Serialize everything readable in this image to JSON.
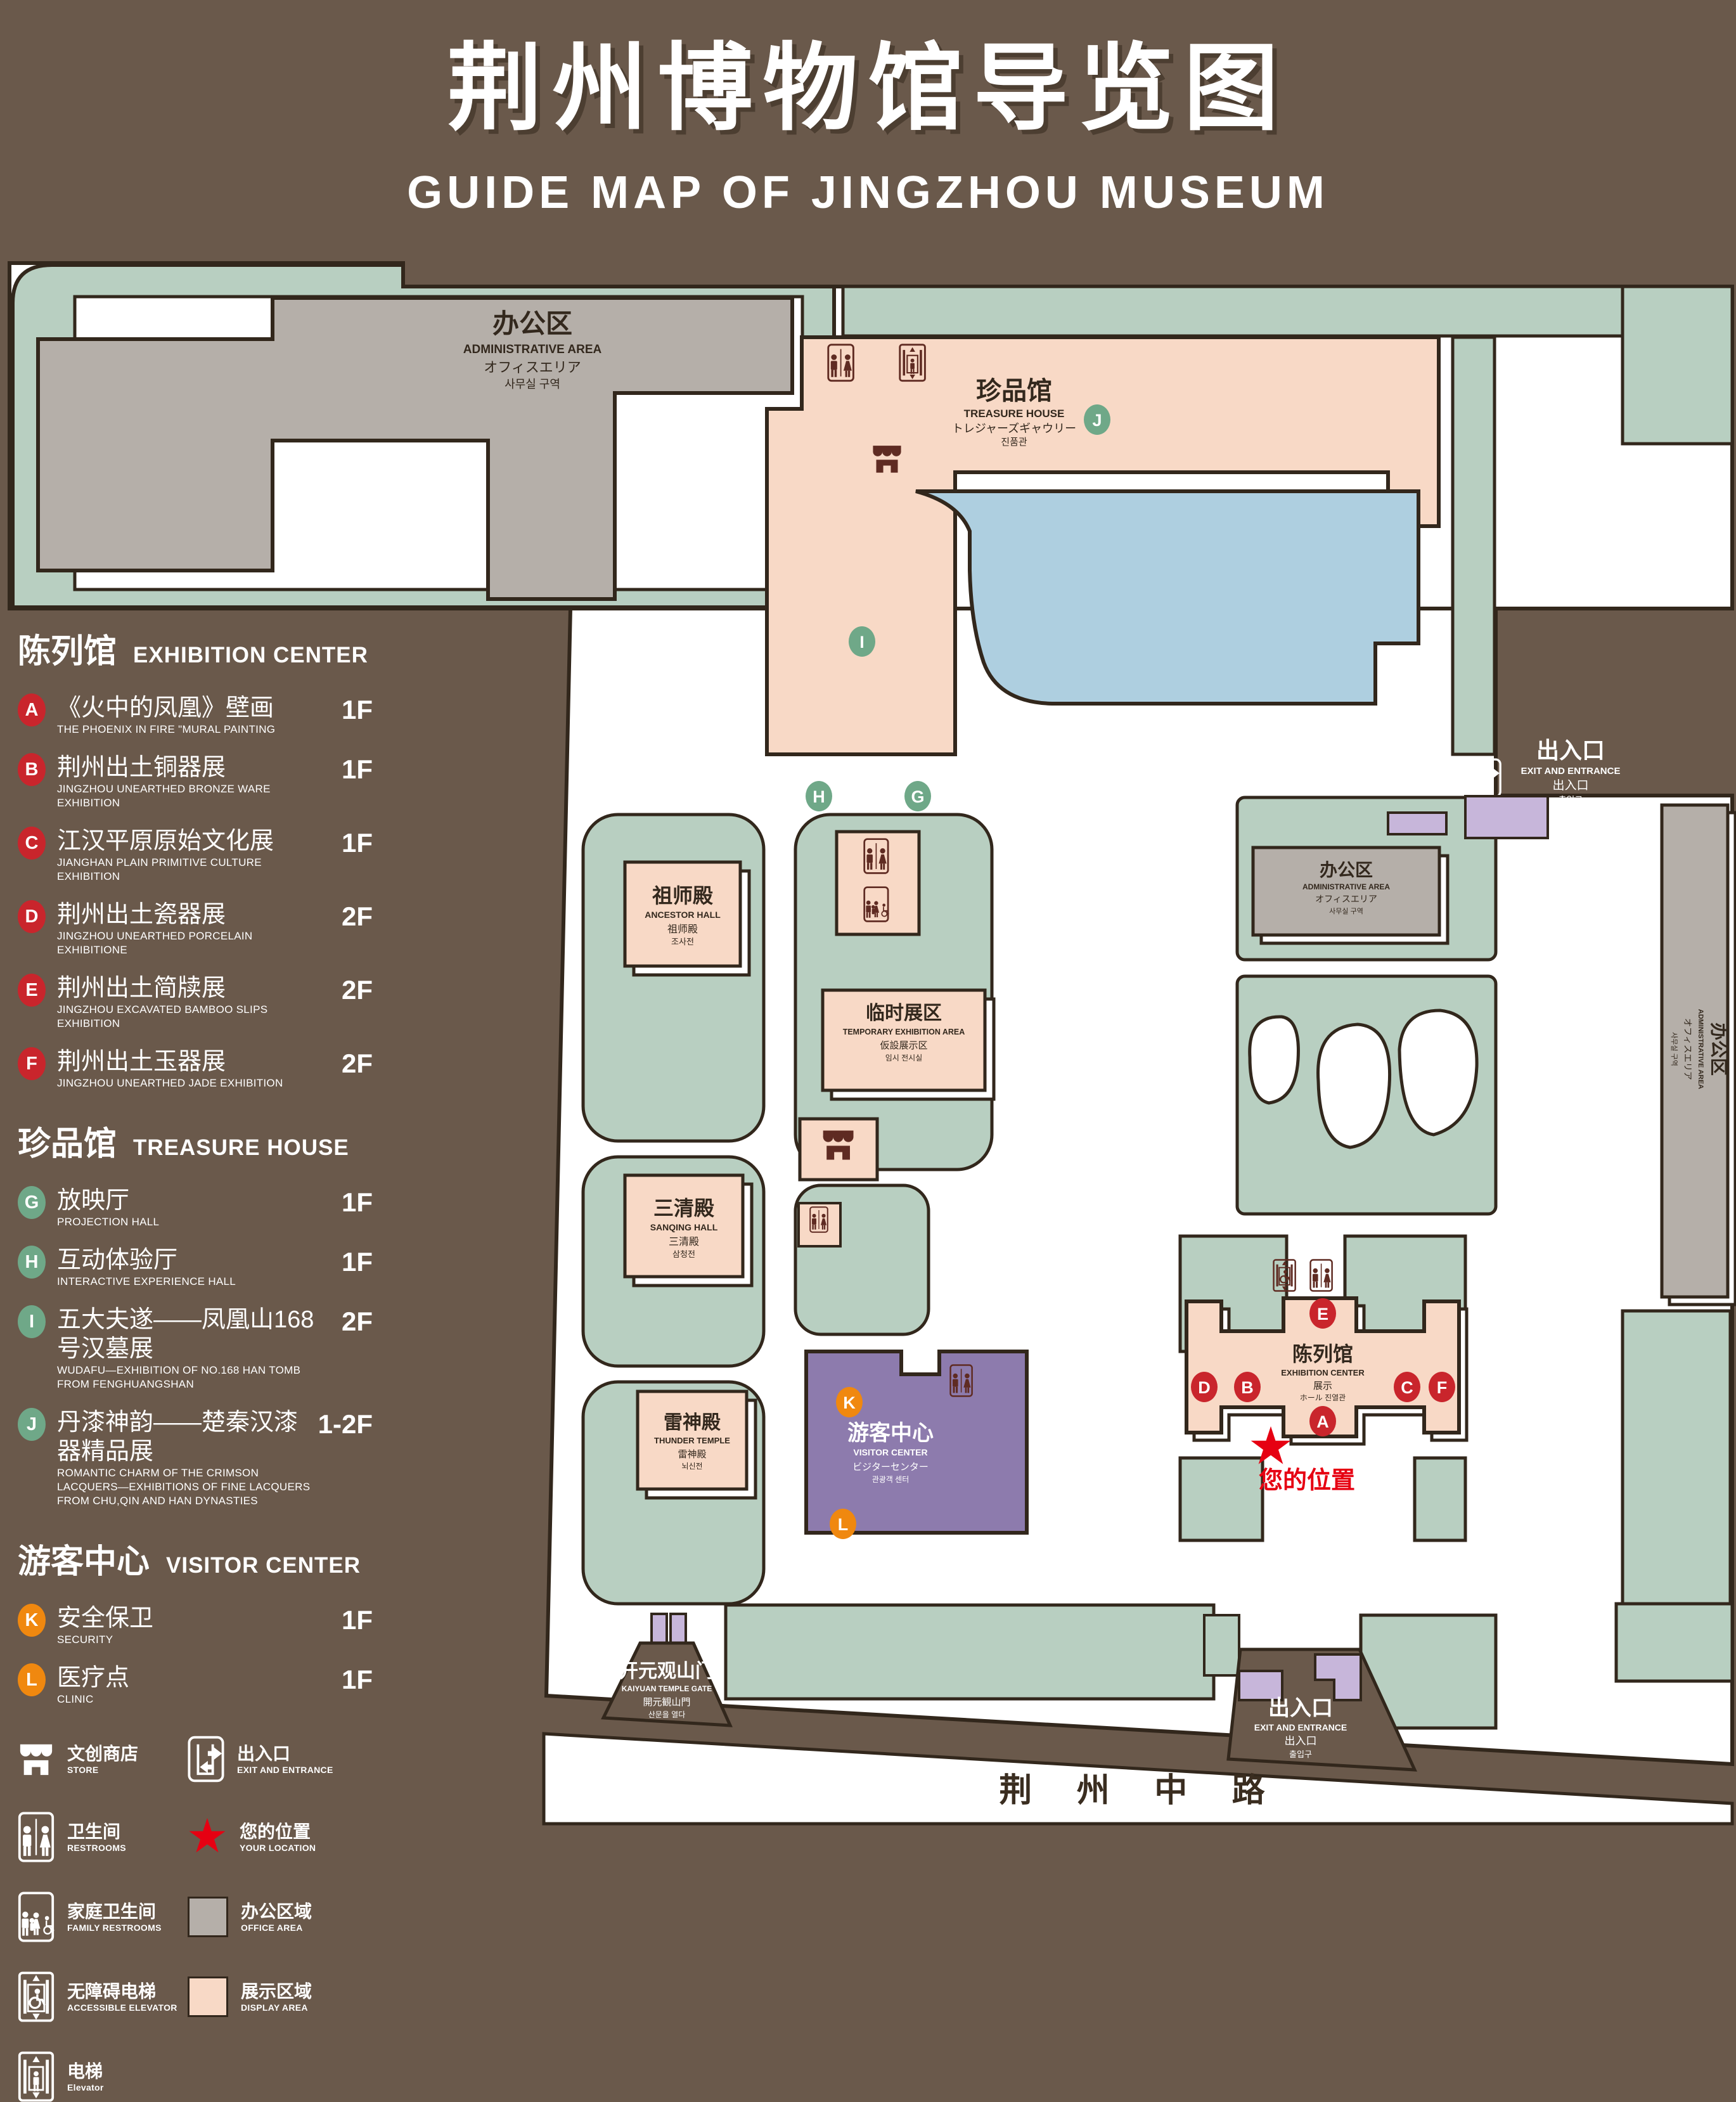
{
  "header": {
    "title_cn": "荆州博物馆导览图",
    "title_en": "GUIDE MAP OF JINGZHOU MUSEUM"
  },
  "colors": {
    "background": "#6a594b",
    "landscape_green": "#b8cfc1",
    "display_pink": "#f8d9c6",
    "office_gray": "#b5afa9",
    "lake_blue": "#aecfe0",
    "visitor_purple": "#8d7bad",
    "entrance_purple": "#c7b6da",
    "outline_dark": "#32271c",
    "badge_red": "#c9252c",
    "badge_green": "#6fa888",
    "badge_orange": "#f0880f",
    "location_red": "#e60012"
  },
  "legend": {
    "sections": [
      {
        "cn": "陈列馆",
        "en": "EXHIBITION CENTER",
        "items": [
          {
            "id": "A",
            "cn": "《火中的凤凰》壁画",
            "en": "THE PHOENIX IN FIRE \"MURAL PAINTING",
            "floor": "1F"
          },
          {
            "id": "B",
            "cn": "荆州出土铜器展",
            "en": "JINGZHOU UNEARTHED BRONZE WARE EXHIBITION",
            "floor": "1F"
          },
          {
            "id": "C",
            "cn": "江汉平原原始文化展",
            "en": "JIANGHAN PLAIN PRIMITIVE CULTURE EXHIBITION",
            "floor": "1F"
          },
          {
            "id": "D",
            "cn": "荆州出土瓷器展",
            "en": "JINGZHOU UNEARTHED PORCELAIN EXHIBITIONE",
            "floor": "2F"
          },
          {
            "id": "E",
            "cn": "荆州出土简牍展",
            "en": "JINGZHOU EXCAVATED BAMBOO SLIPS EXHIBITION",
            "floor": "2F"
          },
          {
            "id": "F",
            "cn": "荆州出土玉器展",
            "en": "JINGZHOU UNEARTHED JADE EXHIBITION",
            "floor": "2F"
          }
        ]
      },
      {
        "cn": "珍品馆",
        "en": "TREASURE HOUSE",
        "items": [
          {
            "id": "G",
            "cn": "放映厅",
            "en": "PROJECTION HALL",
            "floor": "1F"
          },
          {
            "id": "H",
            "cn": "互动体验厅",
            "en": "INTERACTIVE EXPERIENCE HALL",
            "floor": "1F"
          },
          {
            "id": "I",
            "cn": "五大夫遂——凤凰山168号汉墓展",
            "en": "WUDAFU—EXHIBITION OF NO.168 HAN TOMB FROM FENGHUANGSHAN",
            "floor": "2F"
          },
          {
            "id": "J",
            "cn": "丹漆神韵——楚秦汉漆器精品展",
            "en": "ROMANTIC CHARM OF THE CRIMSON LACQUERS—EXHIBITIONS OF FINE LACQUERS FROM CHU,QIN AND HAN DYNASTIES",
            "floor": "1-2F"
          }
        ]
      },
      {
        "cn": "游客中心",
        "en": "VISITOR CENTER",
        "items": [
          {
            "id": "K",
            "cn": "安全保卫",
            "en": "SECURITY",
            "floor": "1F"
          },
          {
            "id": "L",
            "cn": "医疗点",
            "en": "CLINIC",
            "floor": "1F"
          }
        ]
      }
    ],
    "symbols": [
      {
        "icon": "store-icon",
        "cn": "文创商店",
        "en": "STORE"
      },
      {
        "icon": "exit-icon",
        "cn": "出入口",
        "en": "EXIT AND ENTRANCE"
      },
      {
        "icon": "restrooms-icon",
        "cn": "卫生间",
        "en": "RESTROOMS"
      },
      {
        "icon": "location-star-icon",
        "cn": "您的位置",
        "en": "YOUR LOCATION"
      },
      {
        "icon": "family-restroom-icon",
        "cn": "家庭卫生间",
        "en": "FAMILY RESTROOMS"
      },
      {
        "icon": "office-area-swatch",
        "cn": "办公区域",
        "en": "OFFICE AREA"
      },
      {
        "icon": "accessible-elevator-icon",
        "cn": "无障碍电梯",
        "en": "ACCESSIBLE ELEVATOR"
      },
      {
        "icon": "display-area-swatch",
        "cn": "展示区域",
        "en": "DISPLAY AREA"
      },
      {
        "icon": "elevator-icon",
        "cn": "电梯",
        "en": "Elevator"
      }
    ]
  },
  "map": {
    "road": "荆 州 中 路",
    "your_location": "您的位置",
    "markers": {
      "A": "A",
      "B": "B",
      "C": "C",
      "D": "D",
      "E": "E",
      "F": "F",
      "G": "G",
      "H": "H",
      "I": "I",
      "J": "J",
      "K": "K",
      "L": "L"
    },
    "buildings": {
      "admin_nw": {
        "l1": "办公区",
        "l2": "ADMINISTRATIVE AREA",
        "l3": "オフィスエリア",
        "l4": "사무실 구역"
      },
      "treasure": {
        "l1": "珍品馆",
        "l2": "TREASURE HOUSE",
        "l3": "トレジャーズギャウリー",
        "l4": "진품관"
      },
      "ancestor": {
        "l1": "祖师殿",
        "l2": "ANCESTOR HALL",
        "l3": "祖师殿",
        "l4": "조사전"
      },
      "temporary": {
        "l1": "临时展区",
        "l2": "TEMPORARY EXHIBITION AREA",
        "l3": "仮設展示区",
        "l4": "임시 전시실"
      },
      "sanqing": {
        "l1": "三清殿",
        "l2": "SANQING HALL",
        "l3": "三清殿",
        "l4": "삼청전"
      },
      "thunder": {
        "l1": "雷神殿",
        "l2": "THUNDER TEMPLE",
        "l3": "雷神殿",
        "l4": "뇌신전"
      },
      "visitor": {
        "l1": "游客中心",
        "l2": "VISITOR CENTER",
        "l3": "ビジターセンター",
        "l4": "관광객 센터"
      },
      "exhibition": {
        "l1": "陈列馆",
        "l2": "EXHIBITION CENTER",
        "l3": "展示",
        "l4": "ホール 진열관"
      },
      "admin_e": {
        "l1": "办公区",
        "l2": "ADMINISTRATIVE AREA",
        "l3": "オフィスエリア",
        "l4": "사무실 구역"
      },
      "admin_strip": {
        "l1": "办公区",
        "l2": "ADMINISTRATIVE AREA",
        "l3": "オフィスエリア",
        "l4": "사무실 구역"
      },
      "gate": {
        "l1": "开元观山门",
        "l2": "KAIYUAN TEMPLE GATE",
        "l3": "開元観山門",
        "l4": "산문을 열다"
      },
      "exit_east": {
        "l1": "出入口",
        "l2": "EXIT AND ENTRANCE",
        "l3": "出入口",
        "l4": "출입구"
      },
      "exit_south": {
        "l1": "出入口",
        "l2": "EXIT AND ENTRANCE",
        "l3": "出入口",
        "l4": "출입구"
      }
    }
  }
}
